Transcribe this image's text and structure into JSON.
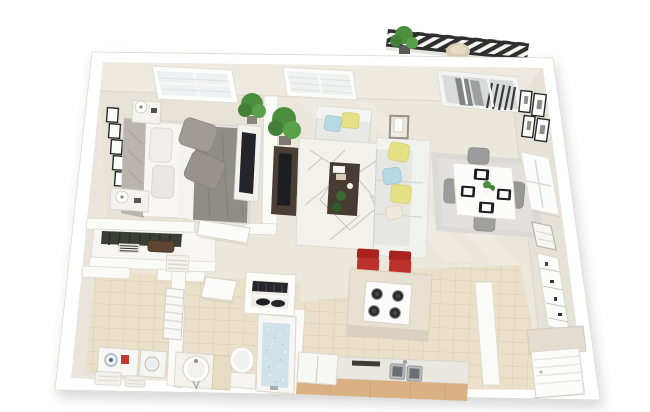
{
  "scene": {
    "title": "3D rendered one-bedroom apartment floor plan, top-down perspective view",
    "rooms": [
      "bedroom",
      "closet",
      "hallway",
      "laundry",
      "bathroom",
      "living-room",
      "dining-area",
      "kitchen",
      "entry",
      "balcony"
    ],
    "furniture": {
      "bedroom": [
        "double-bed",
        "headboard",
        "gray-duvet",
        "pillows",
        "nightstand-left",
        "nightstand-right",
        "table-lamps",
        "dresser-with-tv",
        "wall-art-frames",
        "corner-plant",
        "window"
      ],
      "living_room": [
        "sofa",
        "armchair",
        "coffee-table",
        "tv-console",
        "television",
        "floor-lamp",
        "geometric-rug",
        "potted-plant",
        "window",
        "sliding-glass-door"
      ],
      "dining_area": [
        "square-table",
        "four-chairs",
        "black-placemats",
        "centerpiece",
        "area-rug",
        "wall-art-frames",
        "window"
      ],
      "kitchen": [
        "island-with-cooktop",
        "two-red-bar-stools",
        "counter-run",
        "double-sink",
        "refrigerator",
        "cutting-board"
      ],
      "bathroom": [
        "vanity-with-round-sink",
        "toilet",
        "bathtub-with-water",
        "towel-niche",
        "louvered-window",
        "open-door"
      ],
      "laundry": [
        "washer",
        "dryer",
        "laundry-baskets"
      ],
      "closet": [
        "hanging-clothes",
        "folded-towels",
        "duffel-bag"
      ],
      "balcony": [
        "black-railing",
        "potted-plant",
        "round-chair"
      ],
      "entry": [
        "front-door",
        "tall-wall-shelf"
      ]
    }
  },
  "palette": {
    "background": "#ffffff",
    "wall_white": "#ffffff",
    "wall_face_north": "#eeeae1",
    "wall_face_west": "#e9e5dc",
    "wall_face_east": "#e6e2d8",
    "floor_cream": "#ece7db",
    "bedroom_carpet": "#e8e3d7",
    "tile_tan": "#ebe1ca",
    "tile_grout": "#d9cdae",
    "rug_white": "#f3f1ec",
    "rug_line": "#c9c5bb",
    "dining_rug": "#dbdad6",
    "sofa_gray": "#e6e6e3",
    "armchair_gray": "#e8e8e5",
    "pillow_yellow": "#e7e186",
    "pillow_blue": "#b6d9e3",
    "duvet_gray": "#908c86",
    "bed_pillow_gray": "#a09c95",
    "sheet_white": "#f7f6f3",
    "headboard_gray": "#b9b5ae",
    "wood_dark": "#4a3e35",
    "coffee_table_wood": "#473b32",
    "counter_wood": "#d9b183",
    "island_beige": "#e8e1d2",
    "stool_red": "#bc3129",
    "stool_red_dark": "#a8231f",
    "railing_dark": "#2f2f2f",
    "plant_green": "#4e8f3f",
    "plant_green_dark": "#447f36",
    "water_blue": "#cfe2e8",
    "appliance_white": "#f7f7f4",
    "vanity_tan": "#e7dcc2",
    "chair_gray": "#9c9c9a",
    "glass_gray": "#d8dbda",
    "door_white": "#fcfcfb",
    "clothes_dark": "#3a3e36",
    "bag_brown": "#5d4433",
    "balcony_chair_beige": "#d9cdb6"
  }
}
